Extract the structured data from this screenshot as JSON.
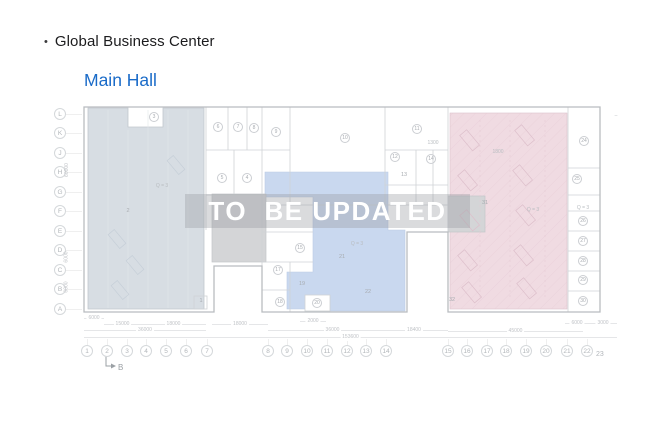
{
  "header": {
    "bullet": "•",
    "title": "Global Business Center",
    "subtitle": "Main Hall"
  },
  "watermark": {
    "text": "TO  BE UPDATED"
  },
  "colors": {
    "accent": "#1a6bc8",
    "zone_left": "#d7dde3",
    "zone_mid": "#c9d8ef",
    "zone_right": "#f0dbe2",
    "gray_room": "#d4d5d7",
    "watermark_band": "rgba(150,153,158,0.35)",
    "watermark_text": "#ffffff"
  },
  "plan": {
    "section_marker": {
      "label": "B"
    },
    "row_labels": [
      {
        "t": "L",
        "y": 114
      },
      {
        "t": "K",
        "y": 133
      },
      {
        "t": "J",
        "y": 153
      },
      {
        "t": "H",
        "y": 172
      },
      {
        "t": "G",
        "y": 192
      },
      {
        "t": "F",
        "y": 211
      },
      {
        "t": "E",
        "y": 231
      },
      {
        "t": "D",
        "y": 250
      },
      {
        "t": "C",
        "y": 270
      },
      {
        "t": "B",
        "y": 289
      },
      {
        "t": "A",
        "y": 309
      }
    ],
    "col_labels": [
      {
        "t": "1",
        "x": 87
      },
      {
        "t": "2",
        "x": 107
      },
      {
        "t": "3",
        "x": 127
      },
      {
        "t": "4",
        "x": 146
      },
      {
        "t": "5",
        "x": 166
      },
      {
        "t": "6",
        "x": 186
      },
      {
        "t": "7",
        "x": 207
      },
      {
        "t": "8",
        "x": 268
      },
      {
        "t": "9",
        "x": 287
      },
      {
        "t": "10",
        "x": 307
      },
      {
        "t": "11",
        "x": 327
      },
      {
        "t": "12",
        "x": 347
      },
      {
        "t": "13",
        "x": 366
      },
      {
        "t": "14",
        "x": 386
      },
      {
        "t": "15",
        "x": 448
      },
      {
        "t": "16",
        "x": 467
      },
      {
        "t": "17",
        "x": 487
      },
      {
        "t": "18",
        "x": 506
      },
      {
        "t": "19",
        "x": 526
      },
      {
        "t": "20",
        "x": 546
      },
      {
        "t": "21",
        "x": 567
      },
      {
        "t": "22",
        "x": 587
      },
      {
        "t": "23",
        "x": 601,
        "y": 355,
        "plain": true
      }
    ],
    "rooms": [
      {
        "t": "3",
        "x": 154,
        "y": 117,
        "c": true
      },
      {
        "t": "5",
        "x": 222,
        "y": 178,
        "c": true
      },
      {
        "t": "4",
        "x": 247,
        "y": 178,
        "c": true
      },
      {
        "t": "6",
        "x": 218,
        "y": 127,
        "c": true
      },
      {
        "t": "7",
        "x": 238,
        "y": 127,
        "c": true
      },
      {
        "t": "8",
        "x": 254,
        "y": 128,
        "c": true
      },
      {
        "t": "9",
        "x": 276,
        "y": 132,
        "c": true
      },
      {
        "t": "10",
        "x": 345,
        "y": 138,
        "c": true
      },
      {
        "t": "11",
        "x": 417,
        "y": 129,
        "c": true
      },
      {
        "t": "12",
        "x": 395,
        "y": 157,
        "c": true
      },
      {
        "t": "14",
        "x": 431,
        "y": 159,
        "c": true
      },
      {
        "t": "15",
        "x": 300,
        "y": 248,
        "c": true
      },
      {
        "t": "17",
        "x": 278,
        "y": 270,
        "c": true
      },
      {
        "t": "18",
        "x": 280,
        "y": 302,
        "c": true
      },
      {
        "t": "20",
        "x": 317,
        "y": 303,
        "c": true
      },
      {
        "t": "24",
        "x": 584,
        "y": 141,
        "c": true
      },
      {
        "t": "25",
        "x": 577,
        "y": 179,
        "c": true
      },
      {
        "t": "26",
        "x": 583,
        "y": 221,
        "c": true
      },
      {
        "t": "27",
        "x": 583,
        "y": 241,
        "c": true
      },
      {
        "t": "28",
        "x": 583,
        "y": 261,
        "c": true
      },
      {
        "t": "29",
        "x": 583,
        "y": 280,
        "c": true
      },
      {
        "t": "30",
        "x": 583,
        "y": 301,
        "c": true
      },
      {
        "t": "1",
        "x": 201,
        "y": 301,
        "c": false
      },
      {
        "t": "2",
        "x": 128,
        "y": 211,
        "c": false
      },
      {
        "t": "13",
        "x": 404,
        "y": 175,
        "c": false
      },
      {
        "t": "19",
        "x": 302,
        "y": 284,
        "c": false
      },
      {
        "t": "21",
        "x": 342,
        "y": 257,
        "c": false
      },
      {
        "t": "22",
        "x": 368,
        "y": 292,
        "c": false
      },
      {
        "t": "31",
        "x": 485,
        "y": 203,
        "c": false
      },
      {
        "t": "32",
        "x": 452,
        "y": 300,
        "c": false
      }
    ],
    "notes": [
      {
        "t": "Q = 3",
        "x": 162,
        "y": 186
      },
      {
        "t": "Q = 3",
        "x": 357,
        "y": 244
      },
      {
        "t": "Q = 3",
        "x": 533,
        "y": 210
      },
      {
        "t": "Q = 3",
        "x": 583,
        "y": 208
      },
      {
        "t": "1300",
        "x": 433,
        "y": 143
      },
      {
        "t": "1800",
        "x": 498,
        "y": 152
      },
      {
        "t": "–",
        "x": 616,
        "y": 116
      }
    ],
    "dims": [
      {
        "t": "6000",
        "x1": 84,
        "x2": 104,
        "y": 318
      },
      {
        "t": "15000",
        "x1": 104,
        "x2": 141,
        "y": 324
      },
      {
        "t": "18000",
        "x1": 141,
        "x2": 206,
        "y": 324
      },
      {
        "t": "18000",
        "x1": 212,
        "x2": 268,
        "y": 324
      },
      {
        "t": "2000",
        "x1": 300,
        "x2": 326,
        "y": 321
      },
      {
        "t": "36000",
        "x1": 84,
        "x2": 206,
        "y": 330
      },
      {
        "t": "36000",
        "x1": 268,
        "x2": 397,
        "y": 330
      },
      {
        "t": "18400",
        "x1": 380,
        "x2": 448,
        "y": 330
      },
      {
        "t": "45000",
        "x1": 448,
        "x2": 583,
        "y": 331
      },
      {
        "t": "6000",
        "x1": 565,
        "x2": 589,
        "y": 323
      },
      {
        "t": "3000",
        "x1": 589,
        "x2": 617,
        "y": 323
      },
      {
        "t": "153600",
        "x1": 84,
        "x2": 617,
        "y": 337
      }
    ],
    "vdims": [
      {
        "t": "60000",
        "x": 70,
        "y": 170
      },
      {
        "t": "6000",
        "x": 71,
        "y": 257
      },
      {
        "t": "6000",
        "x": 71,
        "y": 287
      }
    ]
  }
}
